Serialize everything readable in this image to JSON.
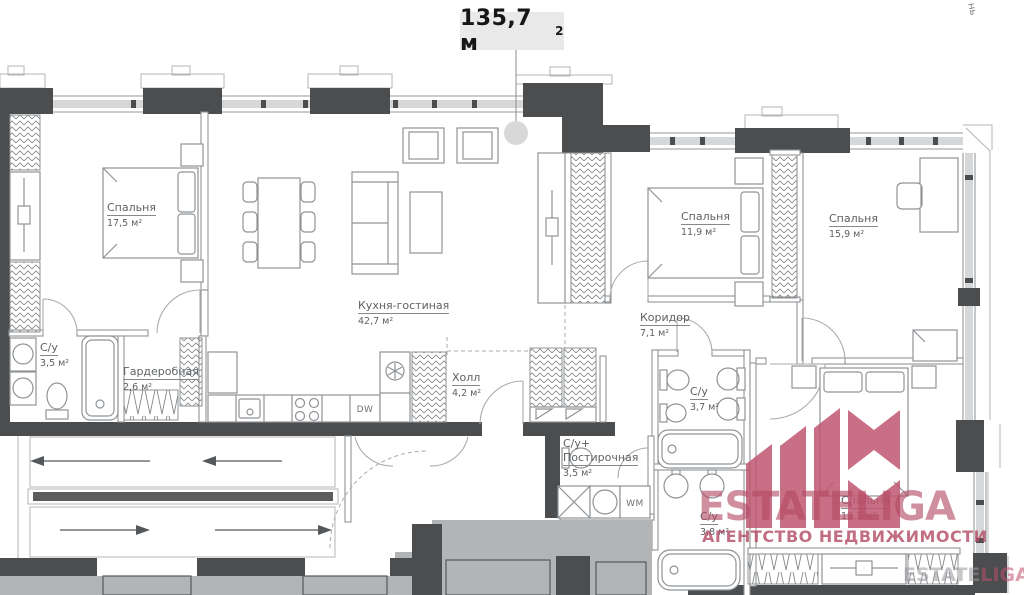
{
  "title": {
    "value": "135,7 м",
    "sup": "2"
  },
  "rooms": [
    {
      "id": "bedroom-1",
      "name": "Спальня",
      "area": "17,5 м²"
    },
    {
      "id": "kitchen-living",
      "name": "Кухня-гостиная",
      "area": "42,7 м²"
    },
    {
      "id": "bathroom-1",
      "name": "С/у",
      "area": "3,5 м²"
    },
    {
      "id": "wardrobe-room",
      "name": "Гардеробная",
      "area": "2,6 м²"
    },
    {
      "id": "hallway",
      "name": "Холл",
      "area": "4,2 м²"
    },
    {
      "id": "bathroom-laundry",
      "name": "С/у+",
      "name2": "Постирочная",
      "area": "3,5 м²"
    },
    {
      "id": "corridor",
      "name": "Коридор",
      "area": "7,1 м²"
    },
    {
      "id": "bedroom-2",
      "name": "Спальня",
      "area": "11,9 м²"
    },
    {
      "id": "bedroom-3",
      "name": "Спальня",
      "area": "15,9 м²"
    },
    {
      "id": "bathroom-2",
      "name": "С/у",
      "area": "3,7 м²"
    },
    {
      "id": "bathroom-3",
      "name": "С/у",
      "area": "3,8 м²"
    },
    {
      "id": "bedroom-4",
      "name": "Спальня",
      "area": "19,3 м²"
    }
  ],
  "appliances": {
    "dishwasher": "DW",
    "washer": "WM"
  },
  "watermark": {
    "brand": "ESTATELIGA",
    "tagline": "АГЕНТСТВО НЕДВИЖИМОСТИ",
    "brand_color": "#c05670",
    "small_part1": "ESTATE",
    "small_part2": "LIGA"
  },
  "edge_label": "нь"
}
